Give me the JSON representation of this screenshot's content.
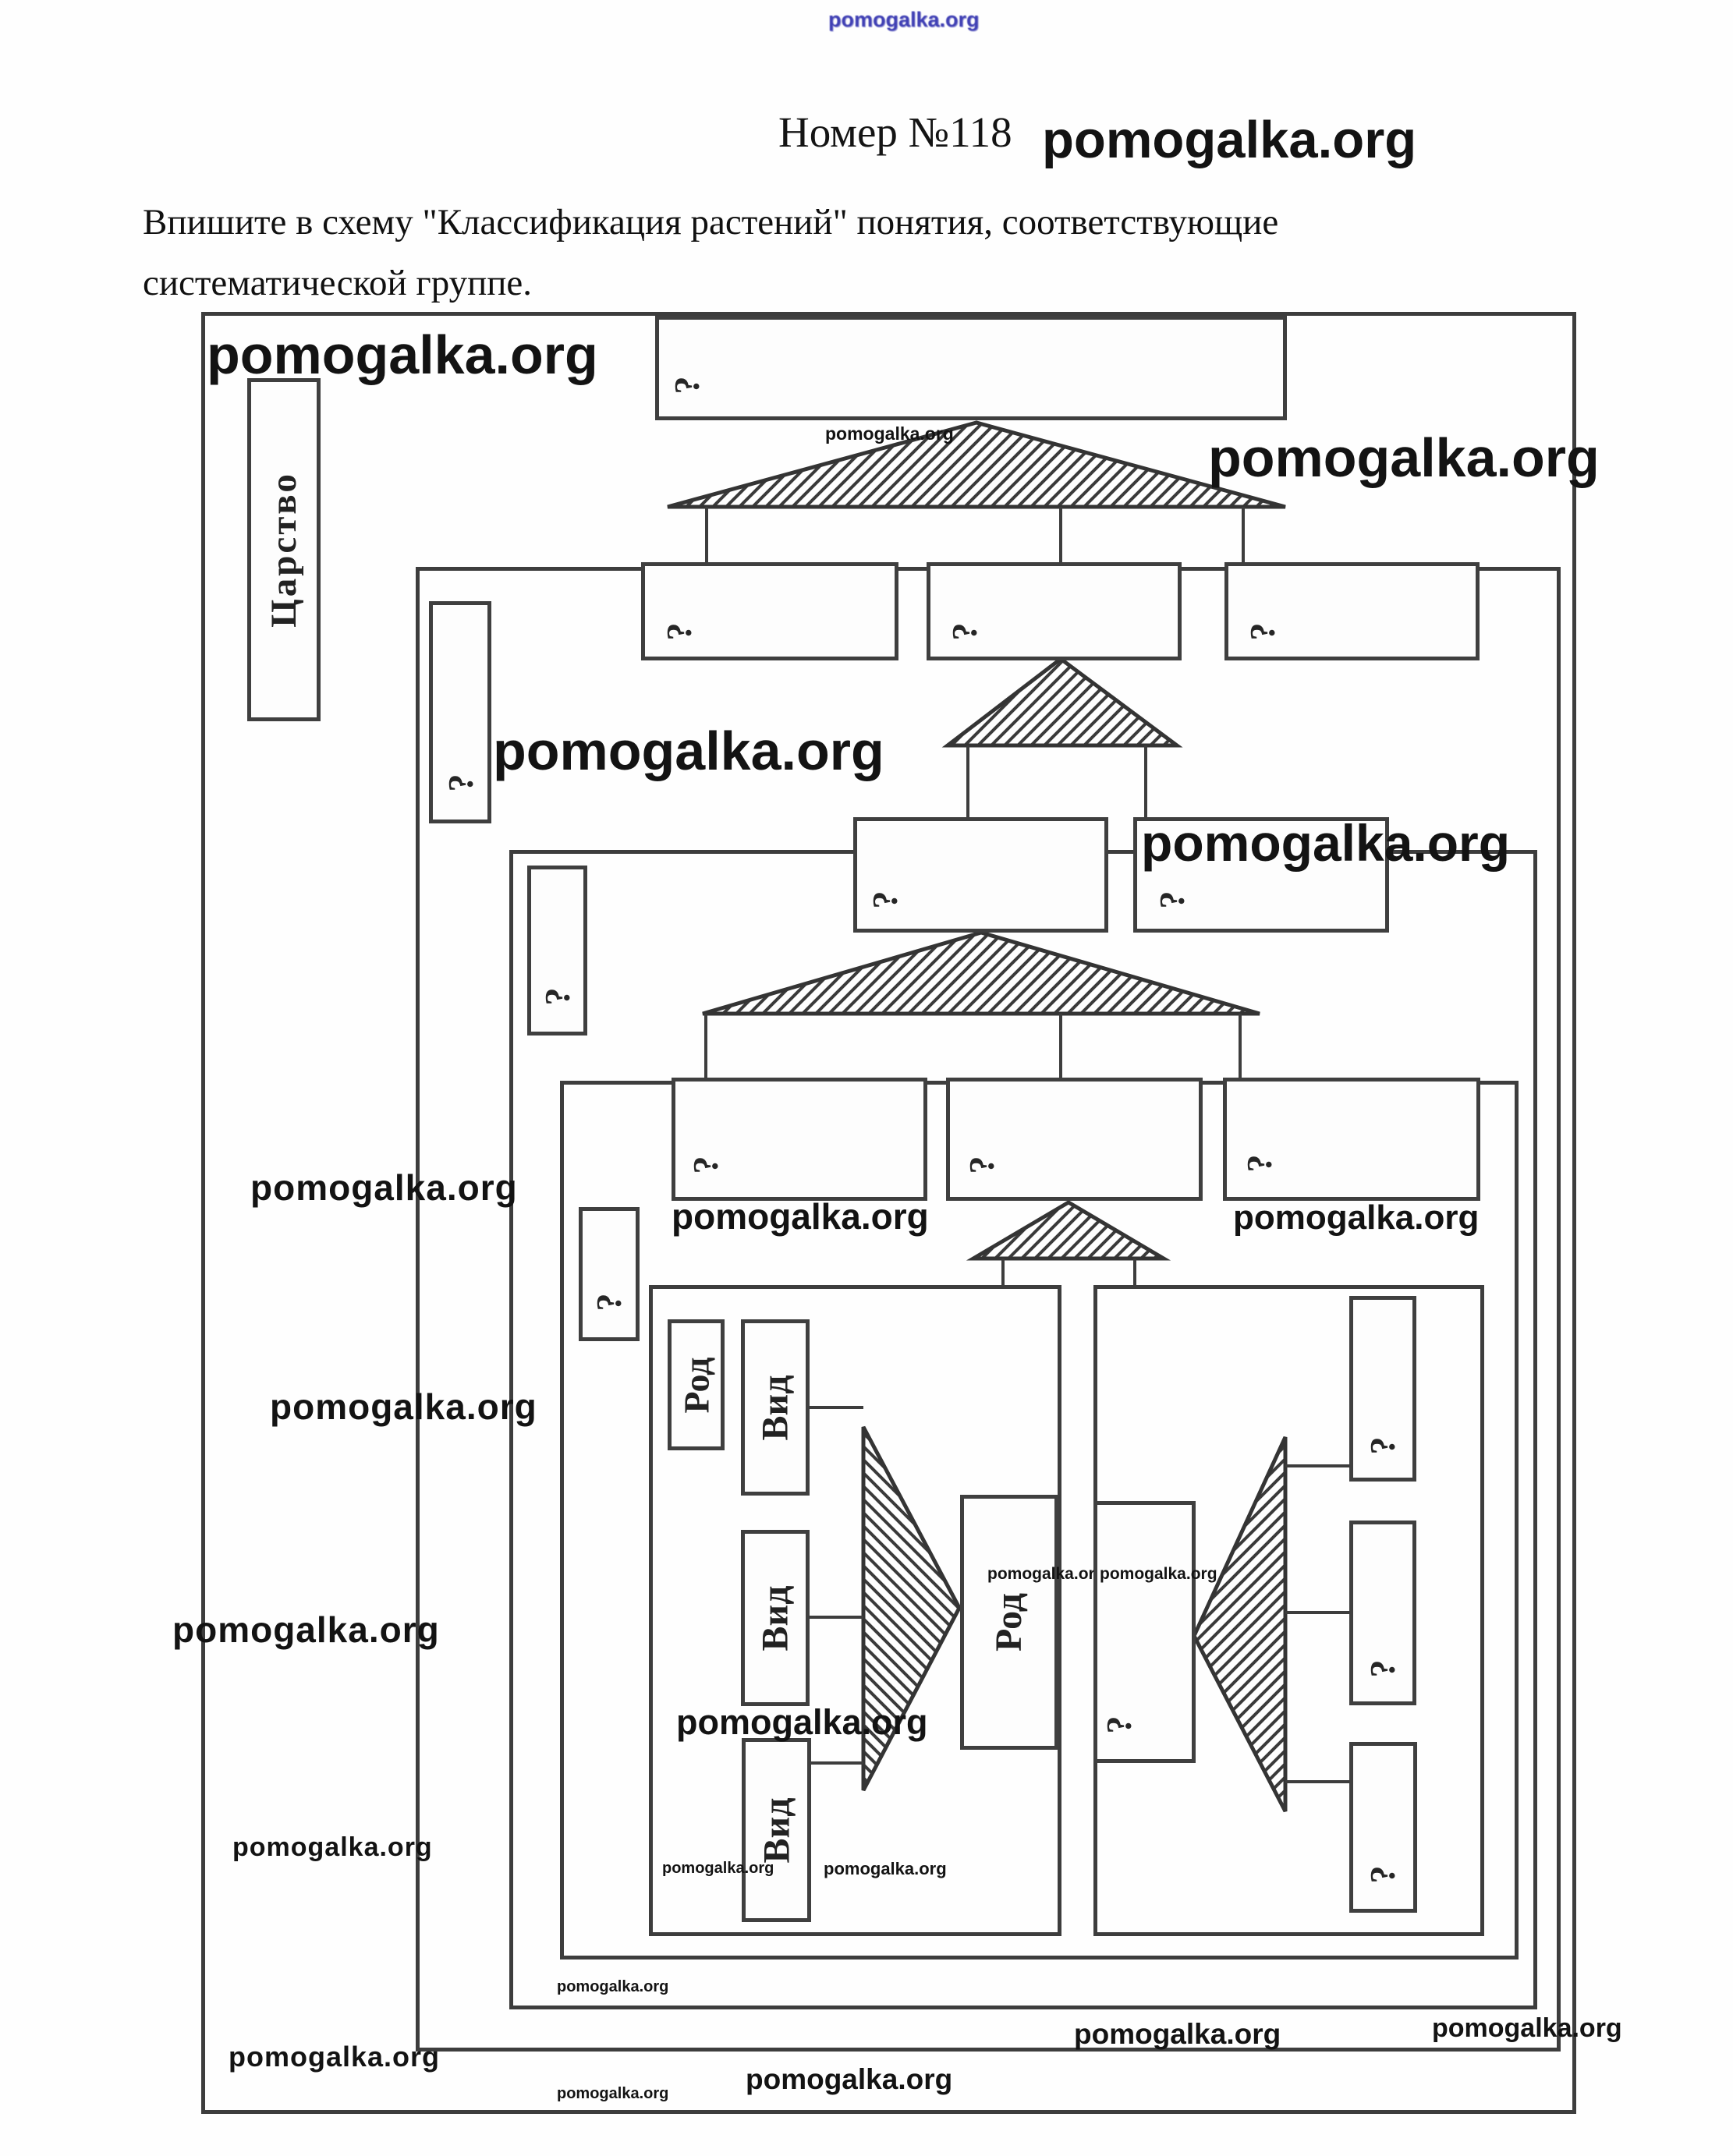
{
  "brand": {
    "watermark": "pomogalka.org"
  },
  "header": {
    "task_number": "Номер №118",
    "instruction_line1": "Впишите в схему \"Классификация растений\" понятия, соответствующие",
    "instruction_line2": "систематической группе."
  },
  "diagram": {
    "question_mark": "?",
    "labels": {
      "kingdom": "Царство",
      "genus": "Род",
      "species": "Вид"
    }
  }
}
